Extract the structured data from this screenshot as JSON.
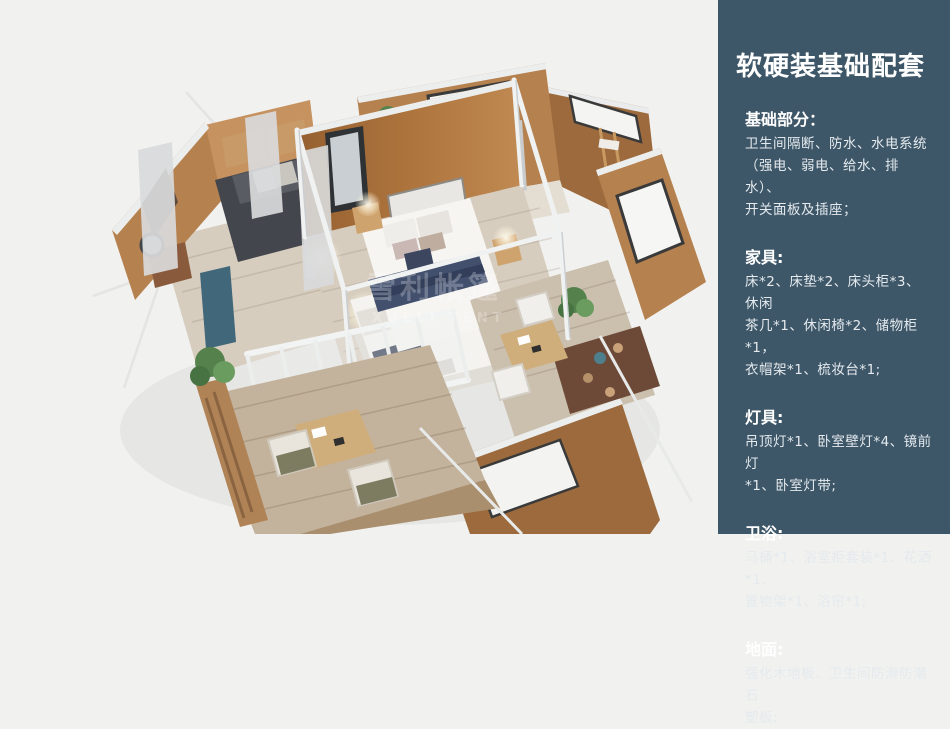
{
  "panel": {
    "title": "软硬装基础配套",
    "sections": [
      {
        "heading": "基础部分：",
        "lines": [
          "卫生间隔断、防水、水电系统",
          "（强电、弱电、给水、排水）、",
          "开关面板及插座；"
        ]
      },
      {
        "heading": "家具:",
        "lines": [
          "床*2、床垫*2、床头柜*3、休闲",
          "茶几*1、休闲椅*2、储物柜*1，",
          "衣帽架*1、梳妆台*1;"
        ]
      },
      {
        "heading": "灯具:",
        "lines": [
          "吊顶灯*1、卧室壁灯*4、镜前灯",
          "*1、卧室灯带;"
        ]
      },
      {
        "heading": "卫浴:",
        "lines": [
          "马桶*1、浴室柜套装*1、花洒*1、",
          "置物架*1、浴帘*1;"
        ]
      },
      {
        "heading": "地面:",
        "lines": [
          "强化木地板、卫生间防滑防潮石",
          "塑板;"
        ]
      }
    ]
  },
  "illustration": {
    "description": "isometric-3d-render-of-tent-cabin-interior",
    "watermark_line1": "雪利帐篷",
    "watermark_line2": "XUELI TENT"
  },
  "colors": {
    "canvas_bg": "#f1f1ef",
    "panel_bg": "#3e5768",
    "heading_color": "#ffffff",
    "body_color": "#e4eaee",
    "wall_orange": "#b5814f",
    "wall_orange_dark": "#9c6a3c",
    "wall_orange_light": "#c6925f",
    "floor_wood": "#d7cdbf",
    "deck_wood": "#c3b29c",
    "frame_white": "#eef0f1",
    "curtain_teal": "#41677a",
    "bed_navy": "#42506e",
    "sofa_dark": "#43464c",
    "plant_green": "#55824c",
    "dark_wood": "#6d4a37",
    "light_wood": "#cfa36e",
    "curtain_gray": "#d9dadb"
  }
}
